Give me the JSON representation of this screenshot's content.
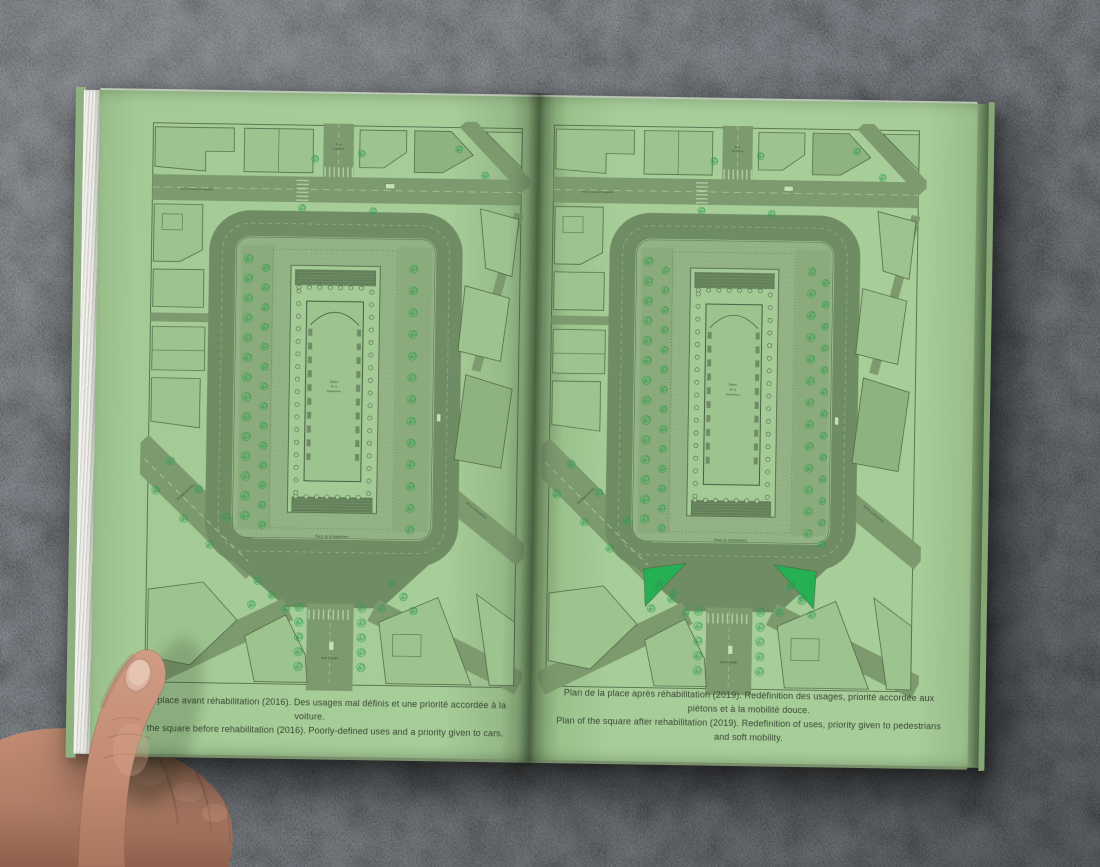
{
  "book": {
    "pages": [
      {
        "id": "before-2016",
        "caption_fr": "Plan de la place avant réhabilitation (2016). Des usages mal définis et une priorité accordée à la voiture.",
        "caption_en": "Plan of the square before rehabilitation (2016). Poorly-defined uses and a priority given to cars."
      },
      {
        "id": "after-2019",
        "caption_fr": "Plan de la place après réhabilitation (2019). Redéfinition des usages, priorité accordée aux piétons et à la mobilité douce.",
        "caption_en": "Plan of the square after rehabilitation (2019). Redefinition of uses, priority given to pedestrians and soft mobility."
      }
    ],
    "map_labels": {
      "church": "Église de la Madeleine",
      "square": "Place de la Madeleine",
      "street_bottom": "Rue Royale",
      "street_top": "Rue Tronchet",
      "street_top_left": "Rue Chauveau Lagarde",
      "boulevard_left": "Bd Malesherbes",
      "boulevard_right": "Bd de la Madeleine"
    },
    "colors": {
      "page_green": "#a7cd99",
      "map_line": "#4a6142",
      "map_line_dark": "#3c523a",
      "road": "#7d9a6f",
      "road_dark": "#708c64",
      "plaza": "#93b285",
      "esplanade": "#8cab7d",
      "block": "#9dc38e",
      "block_dark": "#8eb37f",
      "steps": "#64805a",
      "tree": "#2f9e52",
      "planted": "#24b053",
      "marking": "#a9c79a",
      "crosswalk": "#b7d2a8",
      "caption_text": "#3a4734"
    }
  }
}
